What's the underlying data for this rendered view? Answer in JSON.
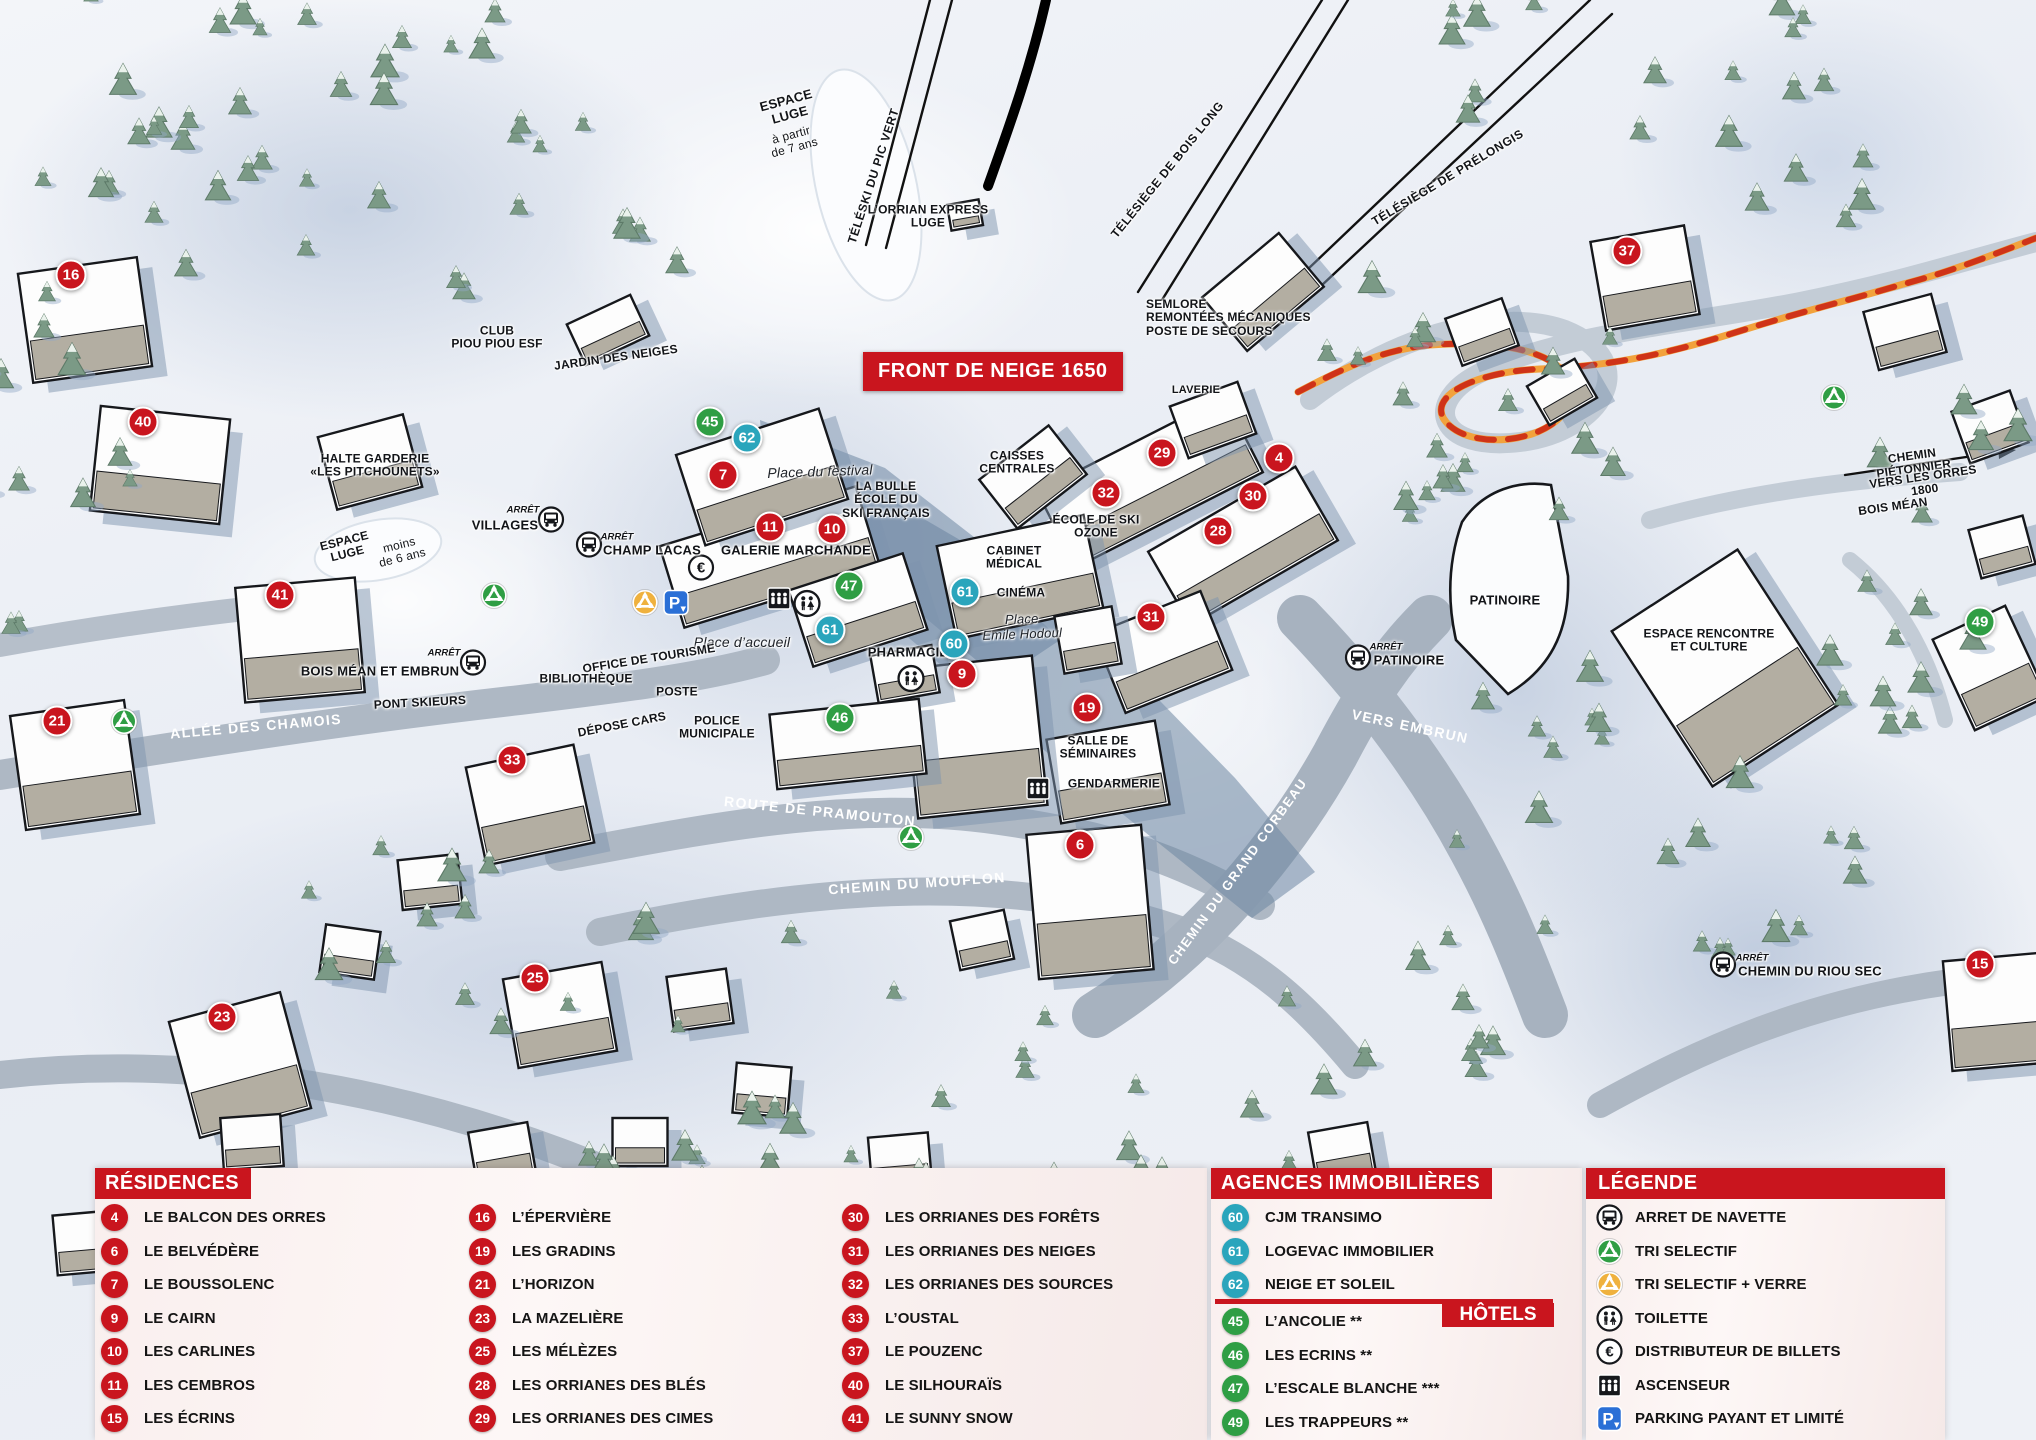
{
  "map": {
    "banner": "FRONT DE NEIGE 1650",
    "colors": {
      "red": "#c9151e",
      "teal": "#2aa5bc",
      "green": "#2f9e44",
      "panel": "#f7ecec",
      "orange_path": "#f2a23c",
      "path_dash": "#cf3318"
    },
    "markers": [
      {
        "n": "16",
        "type": "res",
        "x": 71,
        "y": 275
      },
      {
        "n": "40",
        "type": "res",
        "x": 143,
        "y": 422
      },
      {
        "n": "41",
        "type": "res",
        "x": 280,
        "y": 595
      },
      {
        "n": "21",
        "type": "res",
        "x": 57,
        "y": 721
      },
      {
        "n": "33",
        "type": "res",
        "x": 512,
        "y": 760
      },
      {
        "n": "23",
        "type": "res",
        "x": 222,
        "y": 1017
      },
      {
        "n": "25",
        "type": "res",
        "x": 535,
        "y": 978
      },
      {
        "n": "45",
        "type": "hotel",
        "x": 710,
        "y": 422
      },
      {
        "n": "62",
        "type": "agence",
        "x": 747,
        "y": 438
      },
      {
        "n": "7",
        "type": "res",
        "x": 723,
        "y": 475
      },
      {
        "n": "11",
        "type": "res",
        "x": 770,
        "y": 527
      },
      {
        "n": "10",
        "type": "res",
        "x": 832,
        "y": 529
      },
      {
        "n": "47",
        "type": "hotel",
        "x": 849,
        "y": 586
      },
      {
        "n": "61",
        "type": "agence",
        "x": 830,
        "y": 630
      },
      {
        "n": "46",
        "type": "hotel",
        "x": 840,
        "y": 718
      },
      {
        "n": "61",
        "type": "agence",
        "x": 965,
        "y": 592
      },
      {
        "n": "60",
        "type": "agence",
        "x": 954,
        "y": 644
      },
      {
        "n": "9",
        "type": "res",
        "x": 962,
        "y": 674
      },
      {
        "n": "19",
        "type": "res",
        "x": 1087,
        "y": 708
      },
      {
        "n": "6",
        "type": "res",
        "x": 1080,
        "y": 845
      },
      {
        "n": "29",
        "type": "res",
        "x": 1162,
        "y": 453
      },
      {
        "n": "32",
        "type": "res",
        "x": 1106,
        "y": 493
      },
      {
        "n": "4",
        "type": "res",
        "x": 1279,
        "y": 458
      },
      {
        "n": "30",
        "type": "res",
        "x": 1253,
        "y": 496
      },
      {
        "n": "28",
        "type": "res",
        "x": 1218,
        "y": 531
      },
      {
        "n": "31",
        "type": "res",
        "x": 1151,
        "y": 617
      },
      {
        "n": "37",
        "type": "res",
        "x": 1627,
        "y": 251
      },
      {
        "n": "49",
        "type": "hotel",
        "x": 1980,
        "y": 622
      },
      {
        "n": "15",
        "type": "res",
        "x": 1980,
        "y": 964
      }
    ],
    "labels": [
      {
        "t": "ESPACE\nLUGE",
        "x": 788,
        "y": 108,
        "r": -15,
        "cls": "b",
        "s": 13
      },
      {
        "t": "à partir\nde 7 ans",
        "x": 793,
        "y": 142,
        "r": -15,
        "cls": "n",
        "s": 12
      },
      {
        "t": "TÉLÉSKI DU PIC VERT",
        "x": 874,
        "y": 176,
        "r": -72,
        "cls": "lift",
        "s": 12
      },
      {
        "t": "L’ORRIAN EXPRESS\nLUGE",
        "x": 928,
        "y": 217,
        "r": 0,
        "cls": "b",
        "s": 12
      },
      {
        "t": "TÉLÉSIÈGE DE BOIS LONG",
        "x": 1168,
        "y": 170,
        "r": -51,
        "cls": "lift",
        "s": 12
      },
      {
        "t": "TÉLÉSIÈGE DE PRÉLONGIS",
        "x": 1448,
        "y": 178,
        "r": -31,
        "cls": "lift",
        "s": 12
      },
      {
        "t": "SEMLORE\nREMONTÉES MÉCANIQUES\nPOSTE DE SECOURS",
        "x": 1146,
        "y": 318,
        "r": 0,
        "cls": "b",
        "s": 12,
        "align": "l"
      },
      {
        "t": "CLUB\nPIOU PIOU ESF",
        "x": 497,
        "y": 338,
        "r": 0,
        "cls": "b",
        "s": 12
      },
      {
        "t": "JARDIN DES NEIGES",
        "x": 616,
        "y": 358,
        "r": -8,
        "cls": "b",
        "s": 12
      },
      {
        "t": "HALTE GARDERIE\n«LES PITCHOUNETS»",
        "x": 375,
        "y": 466,
        "r": 0,
        "cls": "b",
        "s": 12
      },
      {
        "t": "ESPACE\nLUGE",
        "x": 346,
        "y": 548,
        "r": -14,
        "cls": "b",
        "s": 12
      },
      {
        "t": "moins\nde 6 ans",
        "x": 401,
        "y": 552,
        "r": -14,
        "cls": "n",
        "s": 12
      },
      {
        "t": "ARRÊT",
        "x": 523,
        "y": 511,
        "r": 0,
        "cls": "arret",
        "s": 9.5
      },
      {
        "t": "VILLAGES",
        "x": 505,
        "y": 526,
        "r": 0,
        "cls": "b",
        "s": 13
      },
      {
        "t": "ARRÊT",
        "x": 617,
        "y": 538,
        "r": 0,
        "cls": "arret",
        "s": 9.5
      },
      {
        "t": "CHAMP LACAS",
        "x": 652,
        "y": 551,
        "r": 0,
        "cls": "b",
        "s": 13
      },
      {
        "t": "Place du festival",
        "x": 820,
        "y": 472,
        "r": -2,
        "cls": "i",
        "s": 14
      },
      {
        "t": "LA BULLE\nÉCOLE DU\nSKI FRANÇAIS",
        "x": 886,
        "y": 500,
        "r": 0,
        "cls": "b",
        "s": 12
      },
      {
        "t": "GALERIE MARCHANDE",
        "x": 796,
        "y": 551,
        "r": 0,
        "cls": "b",
        "s": 13
      },
      {
        "t": "CAISSES\nCENTRALES",
        "x": 1017,
        "y": 463,
        "r": 0,
        "cls": "b",
        "s": 12
      },
      {
        "t": "CABINET\nMÉDICAL",
        "x": 1014,
        "y": 558,
        "r": 0,
        "cls": "b",
        "s": 12
      },
      {
        "t": "CINÉMA",
        "x": 1021,
        "y": 593,
        "r": 0,
        "cls": "b",
        "s": 12
      },
      {
        "t": "Place\nEmile Hodoul",
        "x": 1022,
        "y": 627,
        "r": -2,
        "cls": "i",
        "s": 13
      },
      {
        "t": "PHARMACIE",
        "x": 908,
        "y": 653,
        "r": 0,
        "cls": "b",
        "s": 13
      },
      {
        "t": "ÉCOLE DE SKI\nOZONE",
        "x": 1096,
        "y": 527,
        "r": 0,
        "cls": "b",
        "s": 12
      },
      {
        "t": "LAVERIE",
        "x": 1196,
        "y": 390,
        "r": 0,
        "cls": "b",
        "s": 11
      },
      {
        "t": "Place d’accueil",
        "x": 742,
        "y": 643,
        "r": 0,
        "cls": "i",
        "s": 14
      },
      {
        "t": "OFFICE DE TOURISME",
        "x": 649,
        "y": 659,
        "r": -9,
        "cls": "b",
        "s": 12
      },
      {
        "t": "BIBLIOTHÈQUE",
        "x": 586,
        "y": 679,
        "r": 0,
        "cls": "b",
        "s": 12
      },
      {
        "t": "POSTE",
        "x": 677,
        "y": 692,
        "r": 0,
        "cls": "b",
        "s": 12
      },
      {
        "t": "DÉPOSE CARS",
        "x": 622,
        "y": 725,
        "r": -11,
        "cls": "b",
        "s": 12
      },
      {
        "t": "POLICE\nMUNICIPALE",
        "x": 717,
        "y": 728,
        "r": 0,
        "cls": "b",
        "s": 12
      },
      {
        "t": "ARRÊT",
        "x": 444,
        "y": 654,
        "r": 0,
        "cls": "arret",
        "s": 9.5
      },
      {
        "t": "BOIS MÉAN ET EMBRUN",
        "x": 380,
        "y": 672,
        "r": 0,
        "cls": "b",
        "s": 13
      },
      {
        "t": "PONT SKIEURS",
        "x": 420,
        "y": 703,
        "r": -3,
        "cls": "b",
        "s": 12
      },
      {
        "t": "ALLÉE DES CHAMOIS",
        "x": 256,
        "y": 727,
        "r": -5,
        "cls": "road",
        "s": 14
      },
      {
        "t": "ROUTE DE PRAMOUTON",
        "x": 820,
        "y": 812,
        "r": 6,
        "cls": "road",
        "s": 14
      },
      {
        "t": "CHEMIN DU MOUFLON",
        "x": 917,
        "y": 884,
        "r": -4,
        "cls": "road",
        "s": 14
      },
      {
        "t": "CHEMIN DU GRAND CORBEAU",
        "x": 1238,
        "y": 872,
        "r": -54,
        "cls": "road",
        "s": 13
      },
      {
        "t": "SALLE DE\nSÉMINAIRES",
        "x": 1098,
        "y": 748,
        "r": 0,
        "cls": "b",
        "s": 12
      },
      {
        "t": "GENDARMERIE",
        "x": 1114,
        "y": 784,
        "r": 0,
        "cls": "b",
        "s": 12
      },
      {
        "t": "ARRÊT",
        "x": 1386,
        "y": 648,
        "r": 0,
        "cls": "arret",
        "s": 9.5
      },
      {
        "t": "PATINOIRE",
        "x": 1409,
        "y": 661,
        "r": 0,
        "cls": "b",
        "s": 13
      },
      {
        "t": "VERS EMBRUN",
        "x": 1410,
        "y": 727,
        "r": 12,
        "cls": "road",
        "s": 14
      },
      {
        "t": "PATINOIRE",
        "x": 1505,
        "y": 601,
        "r": 0,
        "cls": "b",
        "s": 13
      },
      {
        "t": "ESPACE RENCONTRE\nET CULTURE",
        "x": 1709,
        "y": 641,
        "r": 0,
        "cls": "b",
        "s": 12
      },
      {
        "t": "CHEMIN PIÉTONNIER",
        "x": 1913,
        "y": 463,
        "r": -8,
        "cls": "b",
        "s": 12
      },
      {
        "t": "VERS LES ORRES 1800",
        "x": 1924,
        "y": 484,
        "r": -8,
        "cls": "b",
        "s": 12
      },
      {
        "t": "BOIS MÉAN",
        "x": 1893,
        "y": 507,
        "r": -8,
        "cls": "b",
        "s": 12
      },
      {
        "t": "ARRÊT",
        "x": 1752,
        "y": 959,
        "r": 0,
        "cls": "arret",
        "s": 9.5
      },
      {
        "t": "CHEMIN DU RIOU SEC",
        "x": 1810,
        "y": 972,
        "r": 0,
        "cls": "b",
        "s": 13
      }
    ],
    "icons": [
      {
        "k": "bus",
        "x": 551,
        "y": 522
      },
      {
        "k": "bus",
        "x": 589,
        "y": 547
      },
      {
        "k": "bus",
        "x": 473,
        "y": 665
      },
      {
        "k": "bus",
        "x": 1358,
        "y": 660
      },
      {
        "k": "bus",
        "x": 1723,
        "y": 967
      },
      {
        "k": "recycle",
        "x": 494,
        "y": 598
      },
      {
        "k": "recycle",
        "x": 124,
        "y": 724
      },
      {
        "k": "recycle",
        "x": 911,
        "y": 840
      },
      {
        "k": "recycle",
        "x": 1834,
        "y": 400
      },
      {
        "k": "recycle-verre",
        "x": 645,
        "y": 605
      },
      {
        "k": "toilette",
        "x": 807,
        "y": 606
      },
      {
        "k": "toilette",
        "x": 911,
        "y": 681
      },
      {
        "k": "euro",
        "x": 701,
        "y": 570
      },
      {
        "k": "parking",
        "x": 676,
        "y": 605
      },
      {
        "k": "ascenseur",
        "x": 779,
        "y": 601
      },
      {
        "k": "ascenseur",
        "x": 1038,
        "y": 791
      }
    ]
  },
  "panels": {
    "residences": {
      "title": "RÉSIDENCES",
      "columns": [
        [
          {
            "n": "4",
            "label": "LE BALCON DES ORRES"
          },
          {
            "n": "6",
            "label": "LE BELVÉDÈRE"
          },
          {
            "n": "7",
            "label": "LE BOUSSOLENC"
          },
          {
            "n": "9",
            "label": "LE CAIRN"
          },
          {
            "n": "10",
            "label": "LES CARLINES"
          },
          {
            "n": "11",
            "label": "LES CEMBROS"
          },
          {
            "n": "15",
            "label": "LES ÉCRINS"
          }
        ],
        [
          {
            "n": "16",
            "label": "L’ÉPERVIÈRE"
          },
          {
            "n": "19",
            "label": "LES GRADINS"
          },
          {
            "n": "21",
            "label": "L’HORIZON"
          },
          {
            "n": "23",
            "label": "LA MAZELIÈRE"
          },
          {
            "n": "25",
            "label": "LES MÉLÈZES"
          },
          {
            "n": "28",
            "label": "LES ORRIANES DES BLÉS"
          },
          {
            "n": "29",
            "label": "LES ORRIANES DES CIMES"
          }
        ],
        [
          {
            "n": "30",
            "label": "LES ORRIANES DES FORÊTS"
          },
          {
            "n": "31",
            "label": "LES ORRIANES DES NEIGES"
          },
          {
            "n": "32",
            "label": "LES ORRIANES DES SOURCES"
          },
          {
            "n": "33",
            "label": "L’OUSTAL"
          },
          {
            "n": "37",
            "label": "LE POUZENC"
          },
          {
            "n": "40",
            "label": "LE SILHOURAÏS"
          },
          {
            "n": "41",
            "label": "LE SUNNY SNOW"
          }
        ]
      ]
    },
    "agences": {
      "title": "AGENCES IMMOBILIÈRES",
      "items": [
        {
          "n": "60",
          "label": "CJM TRANSIMO"
        },
        {
          "n": "61",
          "label": "LOGEVAC IMMOBILIER"
        },
        {
          "n": "62",
          "label": "NEIGE ET SOLEIL"
        }
      ]
    },
    "hotels": {
      "title": "HÔTELS",
      "items": [
        {
          "n": "45",
          "label": "L’ANCOLIE **"
        },
        {
          "n": "46",
          "label": "LES ECRINS **"
        },
        {
          "n": "47",
          "label": "L’ESCALE BLANCHE ***"
        },
        {
          "n": "49",
          "label": "LES TRAPPEURS **"
        }
      ]
    },
    "legende": {
      "title": "LÉGENDE",
      "items": [
        {
          "icon": "bus",
          "label": "ARRET DE NAVETTE"
        },
        {
          "icon": "recycle",
          "label": "TRI SELECTIF"
        },
        {
          "icon": "recycle-verre",
          "label": "TRI SELECTIF + VERRE"
        },
        {
          "icon": "toilette",
          "label": "TOILETTE"
        },
        {
          "icon": "euro",
          "label": "DISTRIBUTEUR DE BILLETS"
        },
        {
          "icon": "ascenseur",
          "label": "ASCENSEUR"
        },
        {
          "icon": "parking",
          "label": "PARKING PAYANT ET LIMITÉ"
        }
      ]
    }
  }
}
